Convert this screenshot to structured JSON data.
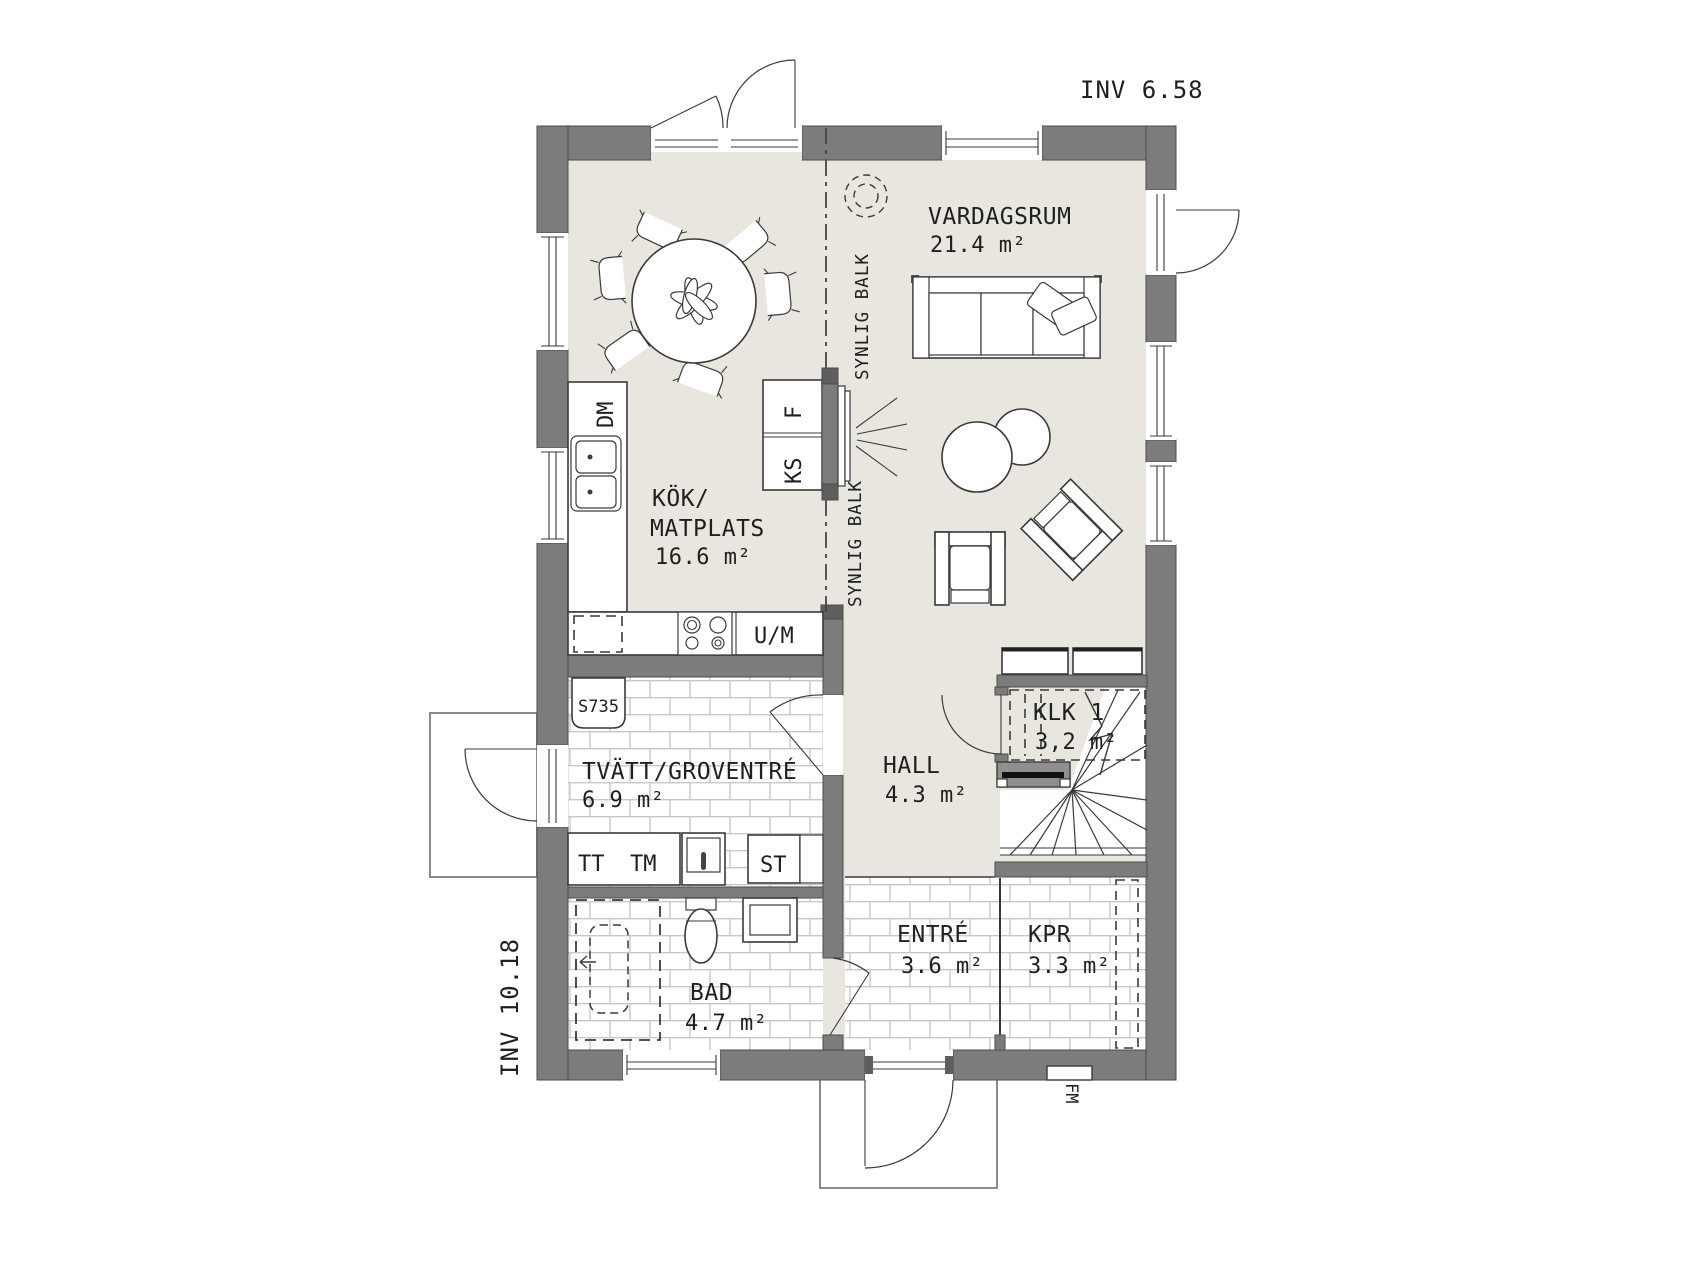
{
  "drawing": {
    "dimension_labels": {
      "top": "INV 6.58",
      "side": "INV 10.18"
    },
    "beam_labels": {
      "upper": "SYNLIG BALK",
      "lower": "SYNLIG BALK"
    },
    "rooms": {
      "vardagsrum": {
        "name": "VARDAGSRUM",
        "area": "21.4 m²"
      },
      "kok": {
        "name_line1": "KÖK/",
        "name_line2": "MATPLATS",
        "area": "16.6 m²"
      },
      "tvatt": {
        "name": "TVÄTT/GROVENTRÉ",
        "area": "6.9 m²"
      },
      "hall": {
        "name": "HALL",
        "area": "4.3 m²"
      },
      "klk": {
        "name": "KLK 1",
        "area": "3,2 m²"
      },
      "entre": {
        "name": "ENTRÉ",
        "area": "3.6 m²"
      },
      "kpr": {
        "name": "KPR",
        "area": "3.3 m²"
      },
      "bad": {
        "name": "BAD",
        "area": "4.7 m²"
      }
    },
    "fixtures": {
      "dishwasher": "DM",
      "fridge": "KS",
      "freezer": "F",
      "oven_micro": "U/M",
      "dryer": "TT",
      "washer": "TM",
      "cleaning_cabinet": "ST",
      "cabinet_model": "S735",
      "meter_cabinet": "FM"
    },
    "colors": {
      "wall": "#7c7c7c",
      "floor": "#e8e6df",
      "tile_line": "#c9c9c3",
      "line": "#3a3a3a"
    }
  }
}
